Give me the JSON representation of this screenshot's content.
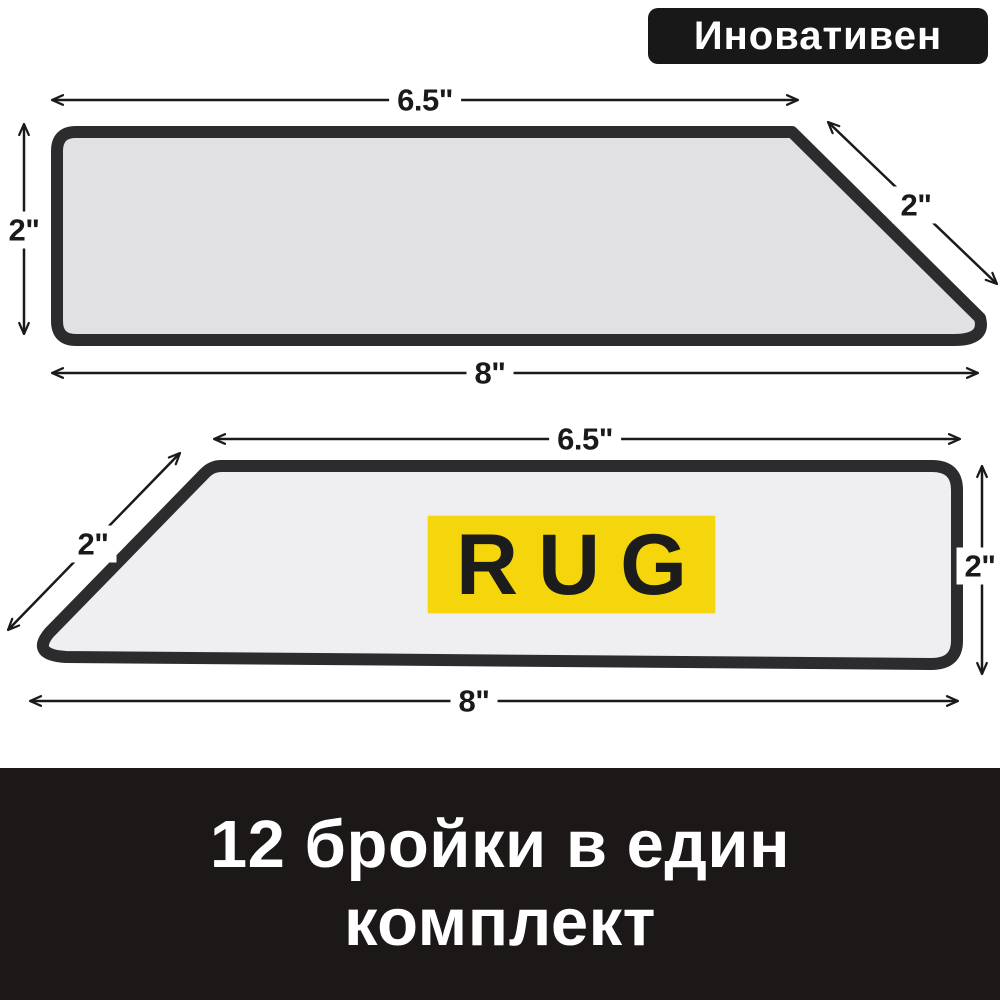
{
  "badge": {
    "label": "Иновативен"
  },
  "product": {
    "strip_top": {
      "dim_top_edge": "6.5\"",
      "dim_left_edge": "2\"",
      "dim_slant_edge": "2\"",
      "dim_bottom_edge": "8\""
    },
    "strip_bottom": {
      "dim_top_edge": "6.5\"",
      "dim_slant_edge": "2\"",
      "dim_right_edge": "2\"",
      "dim_bottom_edge": "8\"",
      "sticker_text": "RUG"
    }
  },
  "footer": {
    "line1": "12 бройки в един",
    "line2": "комплект"
  },
  "colors": {
    "badge_bg": "#181818",
    "strip_border": "#2c2c2e",
    "strip_top_fill": "#e1e1e3",
    "strip_bottom_fill": "#efeff1",
    "sticker_bg": "#f5d60c",
    "sticker_text": "#1c1c1c",
    "dimension_ink": "#1a1a1a",
    "footer_bg": "#1b1817",
    "footer_text": "#ffffff",
    "background": "#ffffff"
  }
}
